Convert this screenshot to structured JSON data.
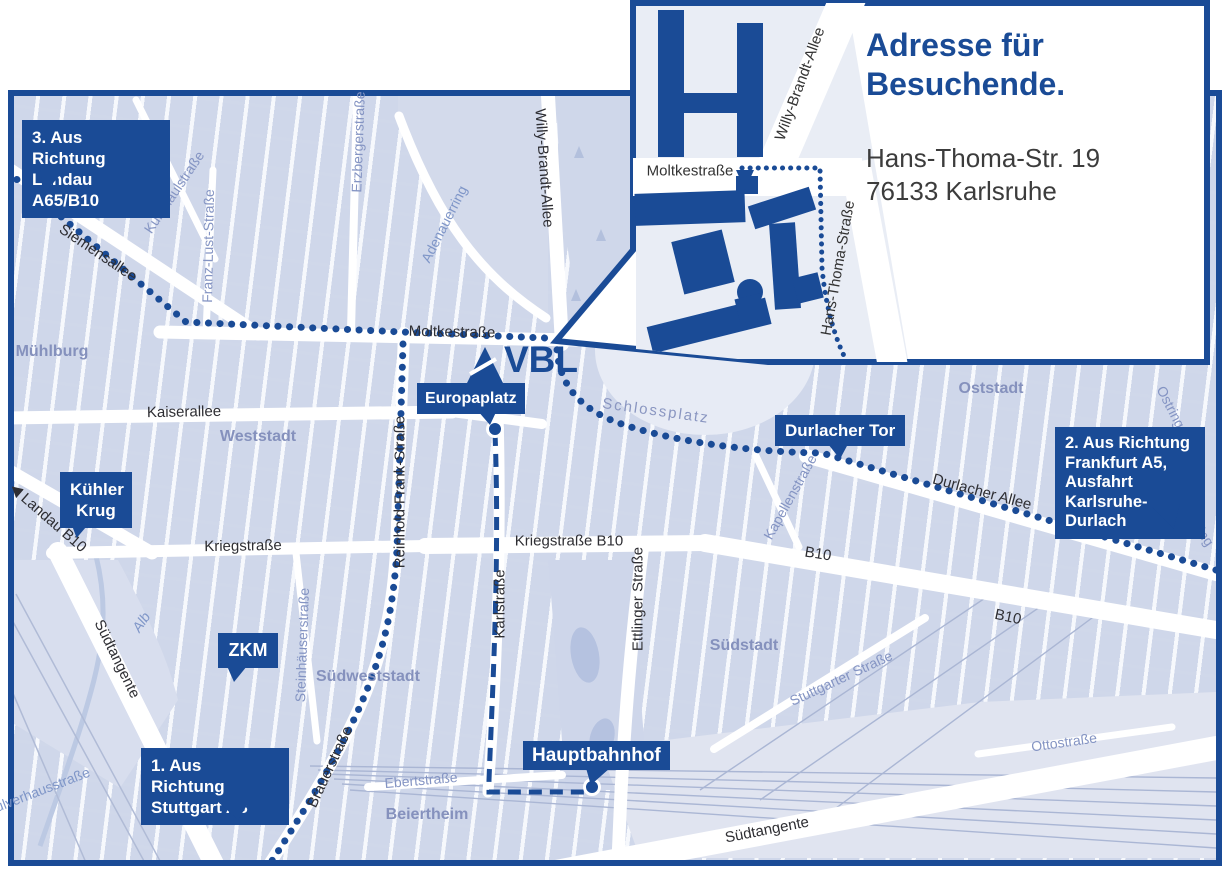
{
  "colors": {
    "primary_blue": "#1a4b96",
    "map_background": "#e6eaf4",
    "park_green": "#cfd7ea"
  },
  "inset": {
    "title_line1": "Adresse für",
    "title_line2": "Besuchende.",
    "address_line1": "Hans-Thoma-Str. 19",
    "address_line2": "76133 Karlsruhe",
    "streets": {
      "moltkestrasse": "Moltkestraße",
      "willy_brandt_allee": "Willy-Brandt-Allee",
      "hans_thoma_strasse": "Hans-Thoma-Straße"
    }
  },
  "logo": {
    "text": "VBL"
  },
  "badges": {
    "landau": {
      "line1": "3. Aus Richtung",
      "line2": "Landau A65/B10"
    },
    "kuehler_krug": {
      "line1": "Kühler",
      "line2": "Krug"
    },
    "zkm": {
      "line1": "ZKM"
    },
    "stuttgart": {
      "line1": "1. Aus Richtung",
      "line2": "Stuttgart A8"
    },
    "europaplatz": {
      "line1": "Europaplatz"
    },
    "durlacher_tor": {
      "line1": "Durlacher Tor"
    },
    "frankfurt": {
      "line1": "2. Aus Richtung",
      "line2": "Frankfurt A5,",
      "line3": "Ausfahrt",
      "line4": "Karlsruhe-Durlach"
    },
    "hauptbahnhof": {
      "line1": "Hauptbahnhof"
    }
  },
  "street_labels": {
    "siemensallee": "Siemensallee",
    "moltkestrasse": "Moltkestraße",
    "kaiserallee": "Kaiserallee",
    "kriegstrasse": "Kriegstraße",
    "kriegstrasse_b10": "Kriegstraße B10",
    "landau_b10": "Landau B10",
    "durlacher_allee": "Durlacher Allee",
    "b10_mid": "B10",
    "b10_east": "B10",
    "suedtangente_west": "Südtangente",
    "suedtangente_sued": "Südtangente",
    "reinhold_frank": "Reinhold-Frank-Straße",
    "karlstrasse": "Karlstraße",
    "ettlinger": "Ettlinger Straße",
    "willy_brandt": "Willy-Brandt-Allee",
    "brauerstrasse": "Brauerstraße",
    "kussmaulstrasse": "Kußmaulstraße",
    "franz_lust": "Franz-Lust-Straße",
    "erzbergerstrasse": "Erzbergerstraße",
    "adenauerring": "Adenauerring",
    "steinhaeuserstrasse": "Steinhäuserstraße",
    "kapellenstrasse": "Kapellenstraße",
    "stuttgarter": "Stuttgarter Straße",
    "ottostrasse": "Ottostraße",
    "ebertstrasse": "Ebertstraße",
    "ostring_a": "Ostring",
    "ostring_b": "Ostring",
    "alb": "Alb",
    "pulverhausstrasse": "Pulverhausstraße"
  },
  "area_labels": {
    "muehlburg": "Mühlburg",
    "weststadt": "Weststadt",
    "oststadt": "Oststadt",
    "suedstadt": "Südstadt",
    "suedweststadt": "Südweststadt",
    "beiertheim": "Beiertheim",
    "schlossplatz": "Schlossplatz"
  }
}
